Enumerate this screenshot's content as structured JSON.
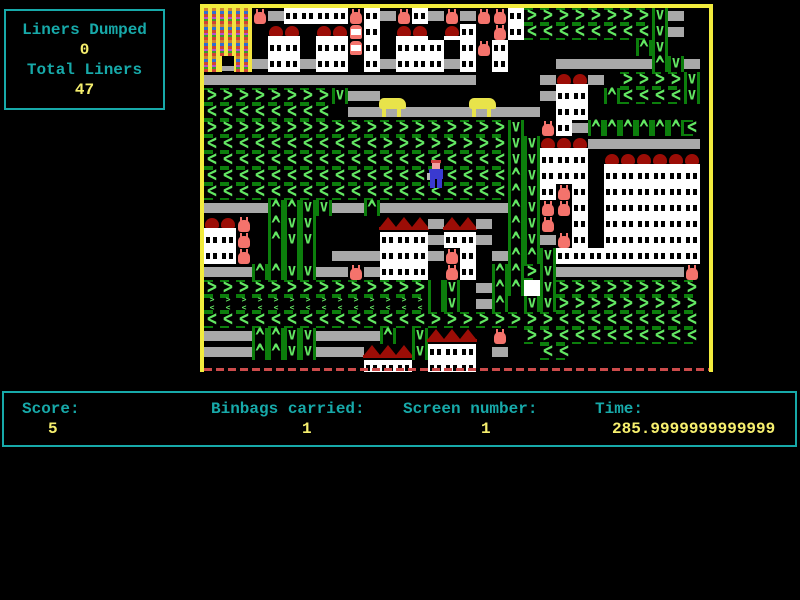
{
  "palette": {
    "teal": "#17a9a9",
    "yellowtext": "#f6ef6e",
    "green-light": "#63e763",
    "green-dark": "#0c7e0c",
    "gray": "#a8a8a8",
    "red-roof": "#9c0d06",
    "bag": "#f4736c",
    "border-yellow": "#f2ec3d",
    "dash-red": "#cc4b4b",
    "dump-yellow": "#f2e441",
    "dog": "#e8e34a",
    "player-blue": "#3a3ad0",
    "skin": "#f2a0a0",
    "hair": "#d04040",
    "white": "#ffffff"
  },
  "hud_panel": {
    "liners_dumped_label": "Liners Dumped",
    "liners_dumped_value": "0",
    "total_liners_label": "Total Liners",
    "total_liners_value": "47"
  },
  "status_bar": {
    "score_label": "Score:",
    "score_value": "5",
    "binbags_label": "Binbags carried:",
    "binbags_value": "1",
    "screen_label": "Screen number:",
    "screen_value": "1",
    "time_label": "Time:",
    "time_value": "285.9999999999999"
  },
  "game": {
    "tile_size": 16,
    "legend": {
      ">": "conveyor-right",
      "<": "conveyor-left",
      "^": "conveyor-up",
      "v": "conveyor-down",
      "g": "conveyor-vertical",
      "s": "conveyor-split",
      "=": "belt",
      "#": "building-window",
      "w": "building-blank",
      "r": "dome-roof",
      "R": "house-roof",
      "b": "binbag",
      "l": "liner-bin",
      "Y": "dump-building",
      "O": "dump-door",
      ".": "empty"
    },
    "map": [
      "YYYb=####b#=b#=b=bb#>>>>>>>>v=..",
      "YYY.rr.rrl#.rr.r#.b#<<<<<<<<v=..",
      "YYY.##.##l#.###.#b#........^v...",
      "YOY=##=##.#=###=#.#...======^v=.",
      "=================....=rr=.>>>>v.",
      ">>>>>>>>v==..........=##.^<<<<v.",
      "<<<<<<<<.============.##........",
      ">>>>>>>>>>>>>>>>>>>v.b#=^^^^^^<.",
      "<<<<<<<<<<<>>>>>>>>vvrrr=======.",
      "<<<<<<<<<<<<<<<<<<<vv###.rrrrrr.",
      "<<<<<<<<<<<<<<<<<<<^v###.######.",
      "<<<<<<<<<<<<<<<<<<<^v#b#.######.",
      "====^^vv==^========^vbb#.######.",
      "rrb.^vv....RRR=RR=.^vb.#.######.",
      "##b.^vv....###=##=.^v=b#.######.",
      "##b.ggg.===###=b#.=^^v#########.",
      "===^^vv==b=###.b#.^^>v========b.",
      ">>>>>>>>>>>>>>gv.=^^wv>>>>>>>>>.",
      "ssssssssssssssgv.=^.vv>>>>>>>>>.",
      "<<<<<<<<<<<<<<>>>>>>>><<<<<<<<<.",
      "===^^vv====^.vRRR.b.>><<<<<<<<<.",
      "===^^vv===RRRv###.=..<<.........",
      "..........###.###..............."
    ],
    "sprites": [
      {
        "type": "player",
        "x": 224,
        "y": 152
      },
      {
        "type": "dog",
        "x": 174,
        "y": 88
      },
      {
        "type": "dog",
        "x": 264,
        "y": 88
      }
    ]
  }
}
